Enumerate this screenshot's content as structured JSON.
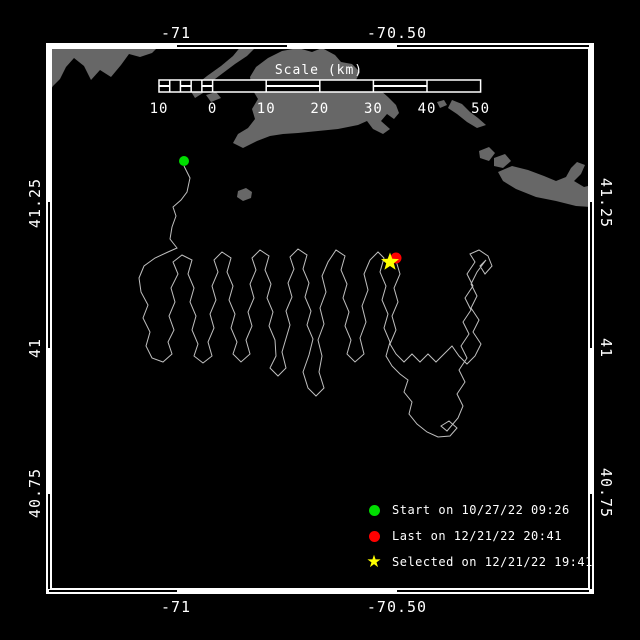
{
  "colors": {
    "background": "#000000",
    "frame": "#ffffff",
    "text": "#ffffff",
    "land": "#676767",
    "track": "#bfbfbf",
    "start": "#00dd00",
    "last": "#ff0000",
    "selected": "#ffff00"
  },
  "frame": {
    "x1": 46,
    "y1": 43,
    "x2": 594,
    "y2": 594,
    "thickness": 6,
    "outlined": {
      "top": [
        [
          177,
          287
        ],
        [
          397,
          589
        ]
      ],
      "bottom": [
        [
          49,
          177
        ],
        [
          397,
          589
        ]
      ],
      "left": [
        [
          202,
          348
        ],
        [
          494,
          589
        ]
      ],
      "right": [
        [
          202,
          348
        ],
        [
          494,
          589
        ]
      ]
    }
  },
  "axes": {
    "top": [
      {
        "text": "-71",
        "x": 176
      },
      {
        "text": "-70.50",
        "x": 397
      }
    ],
    "bottom": [
      {
        "text": "-71",
        "x": 176
      },
      {
        "text": "-70.50",
        "x": 397
      }
    ],
    "left": [
      {
        "text": "41.25",
        "y": 203
      },
      {
        "text": "41",
        "y": 348
      },
      {
        "text": "40.75",
        "y": 493
      }
    ],
    "right": [
      {
        "text": "41.25",
        "y": 203
      },
      {
        "text": "41",
        "y": 348
      },
      {
        "text": "40.75",
        "y": 493
      }
    ],
    "top_label_y": 33,
    "bottom_label_y": 607,
    "left_label_x": 35,
    "right_label_x": 606
  },
  "scale_bar": {
    "title": "Scale (km)",
    "title_x": 319,
    "title_y": 74,
    "x": 159,
    "y": 80,
    "height": 12,
    "km_min": -10,
    "km_max": 50,
    "px_per_km": 5.36,
    "label_y": 113,
    "tick_labels": [
      {
        "text": "10",
        "km": -10
      },
      {
        "text": "0",
        "km": 0
      },
      {
        "text": "10",
        "km": 10
      },
      {
        "text": "20",
        "km": 20
      },
      {
        "text": "30",
        "km": 30
      },
      {
        "text": "40",
        "km": 40
      },
      {
        "text": "50",
        "km": 50
      }
    ],
    "divider_km": [
      0,
      10,
      20,
      30,
      40
    ],
    "subdiv_km": [
      -8,
      -6,
      -4,
      -2
    ],
    "striped_km": [
      [
        -10,
        -8
      ],
      [
        -6,
        -4
      ],
      [
        -2,
        0
      ],
      [
        10,
        20
      ],
      [
        30,
        40
      ]
    ]
  },
  "markers": {
    "start": {
      "x": 184,
      "y": 161,
      "r": 5,
      "color": "#00dd00"
    },
    "last": {
      "x": 396,
      "y": 258,
      "r": 5.5,
      "color": "#ff0000"
    },
    "selected": {
      "x": 390,
      "y": 262,
      "r": 9.5,
      "color": "#ffff00"
    }
  },
  "legend": {
    "items": [
      {
        "marker": "dot",
        "color": "#00dd00",
        "label": "Start on 10/27/22 09:26"
      },
      {
        "marker": "dot",
        "color": "#ff0000",
        "label": "Last on 12/21/22 20:41"
      },
      {
        "marker": "star",
        "color": "#ffff00",
        "label": "Selected on 12/21/22 19:41"
      }
    ],
    "star_glyph": "★"
  },
  "land": [
    {
      "name": "mainland-west",
      "points": [
        [
          46,
          45
        ],
        [
          160,
          45
        ],
        [
          152,
          53
        ],
        [
          140,
          57
        ],
        [
          129,
          54
        ],
        [
          121,
          65
        ],
        [
          111,
          77
        ],
        [
          100,
          70
        ],
        [
          91,
          80
        ],
        [
          84,
          66
        ],
        [
          74,
          58
        ],
        [
          66,
          67
        ],
        [
          60,
          79
        ],
        [
          53,
          86
        ],
        [
          46,
          97
        ]
      ]
    },
    {
      "name": "elizabeth-islands",
      "points": [
        [
          242,
          45
        ],
        [
          258,
          45
        ],
        [
          247,
          56
        ],
        [
          235,
          64
        ],
        [
          223,
          73
        ],
        [
          211,
          82
        ],
        [
          203,
          89
        ],
        [
          196,
          85
        ],
        [
          207,
          76
        ],
        [
          221,
          66
        ],
        [
          233,
          56
        ]
      ]
    },
    {
      "name": "islet-a",
      "points": [
        [
          190,
          90
        ],
        [
          198,
          88
        ],
        [
          203,
          93
        ],
        [
          195,
          98
        ]
      ]
    },
    {
      "name": "islet-b",
      "points": [
        [
          206,
          95
        ],
        [
          216,
          92
        ],
        [
          221,
          98
        ],
        [
          211,
          102
        ]
      ]
    },
    {
      "name": "marthas-vineyard",
      "points": [
        [
          268,
          58
        ],
        [
          282,
          51
        ],
        [
          298,
          48
        ],
        [
          312,
          52
        ],
        [
          322,
          48
        ],
        [
          335,
          55
        ],
        [
          341,
          62
        ],
        [
          352,
          64
        ],
        [
          360,
          72
        ],
        [
          356,
          80
        ],
        [
          362,
          88
        ],
        [
          372,
          92
        ],
        [
          380,
          90
        ],
        [
          388,
          97
        ],
        [
          396,
          105
        ],
        [
          399,
          113
        ],
        [
          394,
          119
        ],
        [
          387,
          114
        ],
        [
          381,
          121
        ],
        [
          390,
          129
        ],
        [
          383,
          134
        ],
        [
          373,
          129
        ],
        [
          367,
          121
        ],
        [
          358,
          125
        ],
        [
          338,
          129
        ],
        [
          318,
          131
        ],
        [
          298,
          133
        ],
        [
          283,
          134
        ],
        [
          270,
          136
        ],
        [
          257,
          141
        ],
        [
          243,
          148
        ],
        [
          233,
          143
        ],
        [
          238,
          134
        ],
        [
          248,
          128
        ],
        [
          255,
          119
        ],
        [
          252,
          109
        ],
        [
          258,
          99
        ],
        [
          252,
          89
        ],
        [
          250,
          77
        ],
        [
          256,
          67
        ]
      ]
    },
    {
      "name": "islets-east",
      "points": [
        [
          452,
          100
        ],
        [
          462,
          104
        ],
        [
          470,
          112
        ],
        [
          478,
          118
        ],
        [
          486,
          125
        ],
        [
          477,
          128
        ],
        [
          467,
          122
        ],
        [
          457,
          114
        ],
        [
          448,
          108
        ]
      ]
    },
    {
      "name": "islet-dot",
      "points": [
        [
          437,
          102
        ],
        [
          444,
          100
        ],
        [
          447,
          105
        ],
        [
          440,
          108
        ]
      ]
    },
    {
      "name": "nomans-land",
      "points": [
        [
          238,
          191
        ],
        [
          246,
          188
        ],
        [
          252,
          192
        ],
        [
          251,
          198
        ],
        [
          243,
          201
        ],
        [
          237,
          197
        ]
      ]
    },
    {
      "name": "tuckernuck",
      "points": [
        [
          479,
          151
        ],
        [
          489,
          147
        ],
        [
          495,
          153
        ],
        [
          489,
          161
        ],
        [
          480,
          158
        ]
      ]
    },
    {
      "name": "muskeget",
      "points": [
        [
          494,
          158
        ],
        [
          505,
          154
        ],
        [
          511,
          161
        ],
        [
          503,
          168
        ],
        [
          494,
          166
        ]
      ]
    },
    {
      "name": "nantucket",
      "points": [
        [
          498,
          172
        ],
        [
          512,
          166
        ],
        [
          528,
          170
        ],
        [
          544,
          176
        ],
        [
          556,
          181
        ],
        [
          566,
          177
        ],
        [
          571,
          168
        ],
        [
          577,
          162
        ],
        [
          585,
          165
        ],
        [
          581,
          174
        ],
        [
          574,
          181
        ],
        [
          584,
          187
        ],
        [
          592,
          185
        ],
        [
          592,
          207
        ],
        [
          576,
          206
        ],
        [
          556,
          201
        ],
        [
          536,
          197
        ],
        [
          516,
          189
        ],
        [
          503,
          181
        ]
      ]
    }
  ],
  "track": [
    [
      184,
      166
    ],
    [
      190,
      178
    ],
    [
      187,
      192
    ],
    [
      181,
      200
    ],
    [
      173,
      207
    ],
    [
      176,
      216
    ],
    [
      172,
      227
    ],
    [
      170,
      239
    ],
    [
      177,
      248
    ],
    [
      168,
      252
    ],
    [
      155,
      258
    ],
    [
      144,
      266
    ],
    [
      139,
      278
    ],
    [
      141,
      292
    ],
    [
      148,
      305
    ],
    [
      143,
      318
    ],
    [
      150,
      332
    ],
    [
      146,
      346
    ],
    [
      152,
      358
    ],
    [
      163,
      362
    ],
    [
      172,
      354
    ],
    [
      168,
      342
    ],
    [
      174,
      330
    ],
    [
      169,
      316
    ],
    [
      175,
      302
    ],
    [
      171,
      288
    ],
    [
      178,
      274
    ],
    [
      173,
      262
    ],
    [
      182,
      255
    ],
    [
      192,
      260
    ],
    [
      188,
      274
    ],
    [
      194,
      288
    ],
    [
      190,
      302
    ],
    [
      196,
      316
    ],
    [
      192,
      330
    ],
    [
      198,
      344
    ],
    [
      194,
      356
    ],
    [
      203,
      363
    ],
    [
      212,
      356
    ],
    [
      208,
      342
    ],
    [
      214,
      328
    ],
    [
      210,
      314
    ],
    [
      216,
      300
    ],
    [
      212,
      286
    ],
    [
      218,
      272
    ],
    [
      214,
      260
    ],
    [
      222,
      252
    ],
    [
      231,
      258
    ],
    [
      227,
      272
    ],
    [
      233,
      286
    ],
    [
      229,
      300
    ],
    [
      235,
      314
    ],
    [
      231,
      328
    ],
    [
      237,
      342
    ],
    [
      233,
      354
    ],
    [
      241,
      362
    ],
    [
      250,
      354
    ],
    [
      246,
      340
    ],
    [
      252,
      326
    ],
    [
      248,
      312
    ],
    [
      254,
      298
    ],
    [
      250,
      284
    ],
    [
      256,
      270
    ],
    [
      252,
      258
    ],
    [
      260,
      250
    ],
    [
      269,
      256
    ],
    [
      265,
      270
    ],
    [
      271,
      284
    ],
    [
      267,
      298
    ],
    [
      273,
      312
    ],
    [
      269,
      326
    ],
    [
      275,
      340
    ],
    [
      276,
      356
    ],
    [
      270,
      368
    ],
    [
      278,
      376
    ],
    [
      286,
      368
    ],
    [
      282,
      352
    ],
    [
      290,
      325
    ],
    [
      286,
      311
    ],
    [
      292,
      297
    ],
    [
      288,
      283
    ],
    [
      294,
      269
    ],
    [
      290,
      257
    ],
    [
      298,
      249
    ],
    [
      307,
      255
    ],
    [
      303,
      269
    ],
    [
      309,
      283
    ],
    [
      305,
      297
    ],
    [
      311,
      311
    ],
    [
      307,
      325
    ],
    [
      313,
      339
    ],
    [
      309,
      355
    ],
    [
      303,
      372
    ],
    [
      308,
      388
    ],
    [
      316,
      396
    ],
    [
      324,
      388
    ],
    [
      319,
      372
    ],
    [
      322,
      356
    ],
    [
      318,
      340
    ],
    [
      324,
      324
    ],
    [
      320,
      308
    ],
    [
      326,
      292
    ],
    [
      322,
      276
    ],
    [
      328,
      262
    ],
    [
      336,
      250
    ],
    [
      345,
      256
    ],
    [
      341,
      270
    ],
    [
      347,
      284
    ],
    [
      343,
      298
    ],
    [
      349,
      312
    ],
    [
      345,
      326
    ],
    [
      351,
      340
    ],
    [
      347,
      354
    ],
    [
      355,
      362
    ],
    [
      364,
      354
    ],
    [
      360,
      338
    ],
    [
      366,
      322
    ],
    [
      362,
      306
    ],
    [
      368,
      290
    ],
    [
      364,
      274
    ],
    [
      370,
      260
    ],
    [
      378,
      252
    ],
    [
      384,
      258
    ],
    [
      380,
      272
    ],
    [
      386,
      286
    ],
    [
      382,
      300
    ],
    [
      388,
      314
    ],
    [
      384,
      328
    ],
    [
      390,
      342
    ],
    [
      386,
      356
    ],
    [
      392,
      366
    ],
    [
      400,
      374
    ],
    [
      408,
      380
    ],
    [
      404,
      392
    ],
    [
      412,
      402
    ],
    [
      409,
      414
    ],
    [
      417,
      424
    ],
    [
      427,
      432
    ],
    [
      438,
      437
    ],
    [
      450,
      436
    ],
    [
      457,
      428
    ],
    [
      449,
      421
    ],
    [
      441,
      426
    ],
    [
      447,
      431
    ],
    [
      458,
      418
    ],
    [
      463,
      406
    ],
    [
      457,
      394
    ],
    [
      465,
      382
    ],
    [
      459,
      370
    ],
    [
      467,
      358
    ],
    [
      461,
      346
    ],
    [
      469,
      334
    ],
    [
      463,
      322
    ],
    [
      471,
      310
    ],
    [
      465,
      298
    ],
    [
      473,
      286
    ],
    [
      467,
      274
    ],
    [
      475,
      262
    ],
    [
      470,
      254
    ],
    [
      479,
      250
    ],
    [
      488,
      256
    ],
    [
      492,
      266
    ],
    [
      485,
      274
    ],
    [
      480,
      266
    ],
    [
      486,
      260
    ],
    [
      477,
      272
    ],
    [
      471,
      284
    ],
    [
      477,
      296
    ],
    [
      471,
      308
    ],
    [
      479,
      320
    ],
    [
      473,
      332
    ],
    [
      481,
      344
    ],
    [
      475,
      356
    ],
    [
      467,
      364
    ],
    [
      459,
      356
    ],
    [
      452,
      346
    ],
    [
      444,
      354
    ],
    [
      436,
      362
    ],
    [
      428,
      354
    ],
    [
      420,
      362
    ],
    [
      412,
      354
    ],
    [
      404,
      362
    ],
    [
      396,
      354
    ],
    [
      390,
      344
    ],
    [
      396,
      330
    ],
    [
      392,
      316
    ],
    [
      398,
      302
    ],
    [
      394,
      288
    ],
    [
      400,
      274
    ],
    [
      397,
      264
    ],
    [
      396,
      258
    ]
  ]
}
